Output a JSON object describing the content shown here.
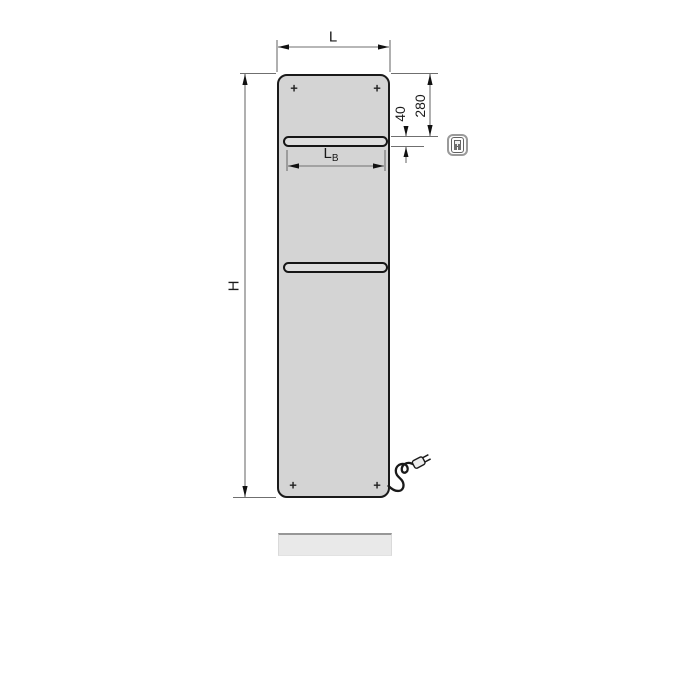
{
  "diagram": {
    "kind": "electric panel radiator dimensional drawing",
    "labels": {
      "width": "L",
      "height": "H",
      "bar_width_main": "L",
      "bar_width_sub": "B",
      "offset_top": "280",
      "bar_height": "40",
      "mounting_mark": "+"
    },
    "icon": {
      "name": "electric-control-unit-icon"
    },
    "colors": {
      "panel_fill": "#d4d4d4",
      "panel_border": "#1a1a1a",
      "slot_fill": "#dedede",
      "dimension_line": "#6f6f6f",
      "shadow_fill": "#e9e9e9",
      "shadow_edge": "#979797"
    }
  }
}
